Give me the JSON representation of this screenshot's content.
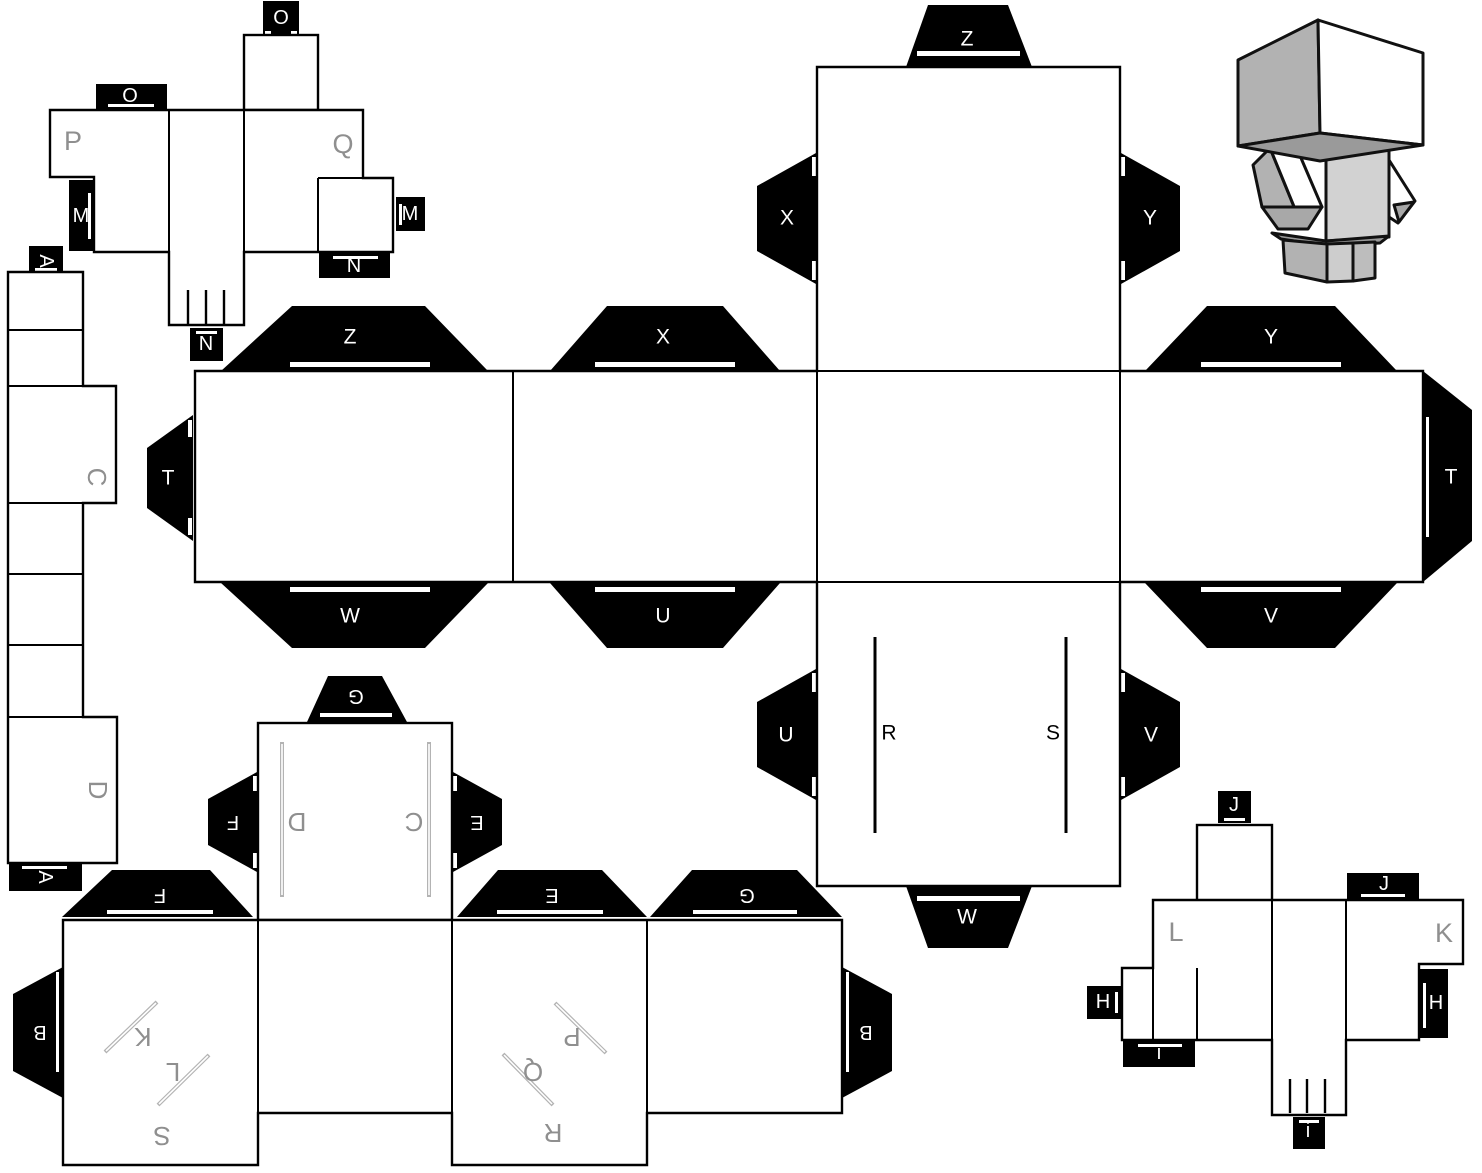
{
  "colors": {
    "ink": "#000000",
    "paper": "#ffffff",
    "label_gray": "#8f8f8f",
    "slit_gray": "#b3b3b3",
    "preview_gray_light": "#d2d2d2",
    "preview_gray_mid": "#b2b2b2",
    "preview_gray_dark": "#9a9a9a"
  },
  "pieces": {
    "head_box": {
      "o_tab_top": "O",
      "o_tab_side": "O",
      "face_p": "P",
      "face_q": "Q",
      "m_tab_left": "M",
      "m_tab_right": "M",
      "n_tab_bottom": "N",
      "n_tab_side": "N"
    },
    "side_strip": {
      "a_tab_top": "A",
      "face_c": "C",
      "face_d": "D",
      "a_tab_bottom": "A"
    },
    "body_cross": {
      "z_tab_left": "Z",
      "x_tab_mid": "X",
      "y_tab_right": "Y",
      "t_tab_left": "T",
      "t_tab_right": "T",
      "w_tab_left": "W",
      "u_tab_mid": "U",
      "v_tab_right": "V",
      "z_tab_top": "Z",
      "x_side_tab": "X",
      "y_side_tab": "Y",
      "u_side_tab": "U",
      "v_side_tab": "V",
      "w_tab_bottom": "W",
      "slit_r": "R",
      "slit_s": "S"
    },
    "legs_cross": {
      "g_tab_top": "G",
      "f_side_tab": "F",
      "e_side_tab": "E",
      "slit_d": "D",
      "slit_c": "C",
      "f_tab": "F",
      "e_tab": "E",
      "g_tab": "G",
      "b_tab_left": "B",
      "b_tab_right": "B",
      "slit_k": "K",
      "slit_l": "L",
      "face_s": "S",
      "slit_p": "P",
      "slit_q": "Q",
      "face_r": "R"
    },
    "foot_box": {
      "j_tab_top": "J",
      "j_tab_side": "J",
      "face_l": "L",
      "face_k": "K",
      "h_tab_left": "H",
      "h_tab_right": "H",
      "i_tab_left": "i",
      "i_tab_bottom": "i"
    }
  }
}
